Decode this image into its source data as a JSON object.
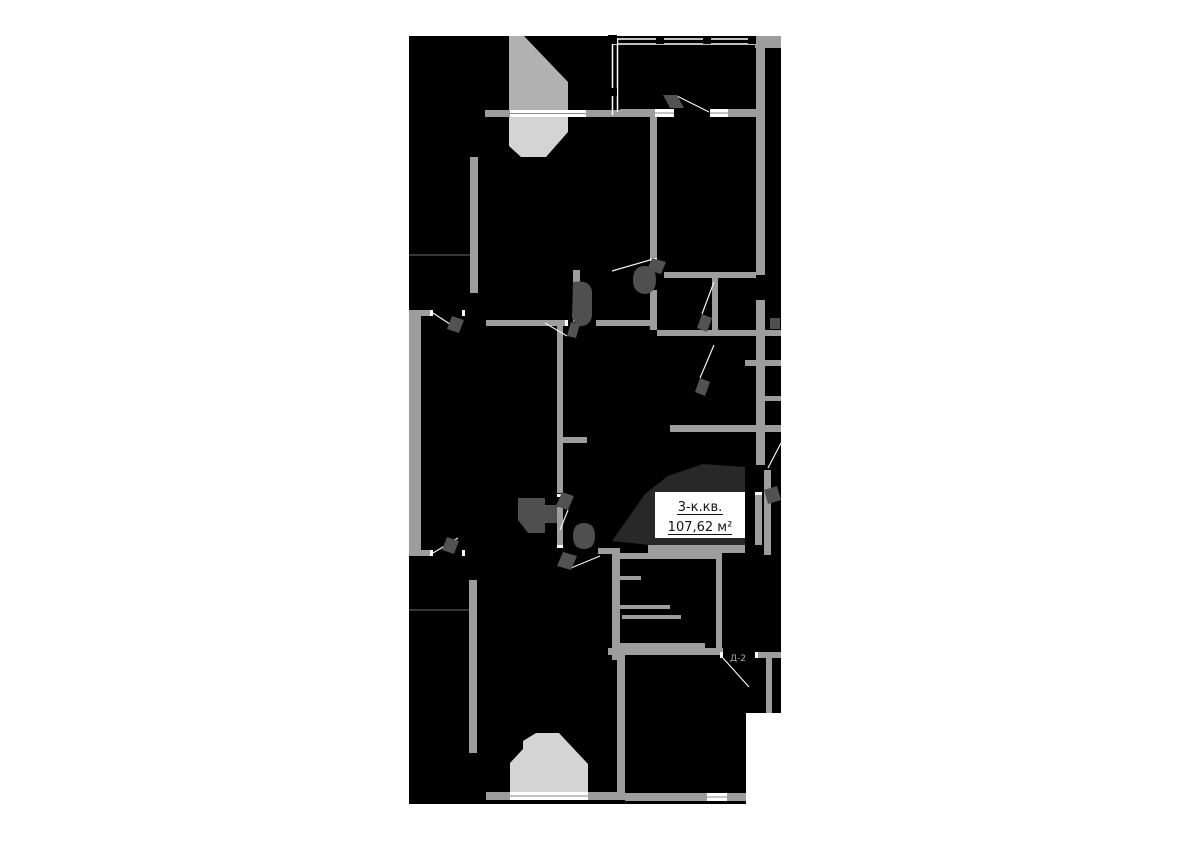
{
  "plan": {
    "title": "apartment floor plan",
    "apartment_label": {
      "type": "3-к.кв.",
      "area": "107,62 м²"
    },
    "door_labels": {
      "d2": "Д-2"
    },
    "colors": {
      "page_background": "#ffffff",
      "plan_fill": "#000000",
      "wall": "#9d9d9d",
      "window": "#ffffff",
      "stair_upper": "#b1b1b1",
      "stair_lower": "#d4d4d4",
      "hall_fill": "#282828",
      "fixture": "#4f4f4f",
      "door_leaf": "#525252",
      "swing_line": "#f2f2f2",
      "label_box": "#ffffff",
      "label_text": "#141414",
      "door_label_text": "#a9a9a9"
    }
  }
}
